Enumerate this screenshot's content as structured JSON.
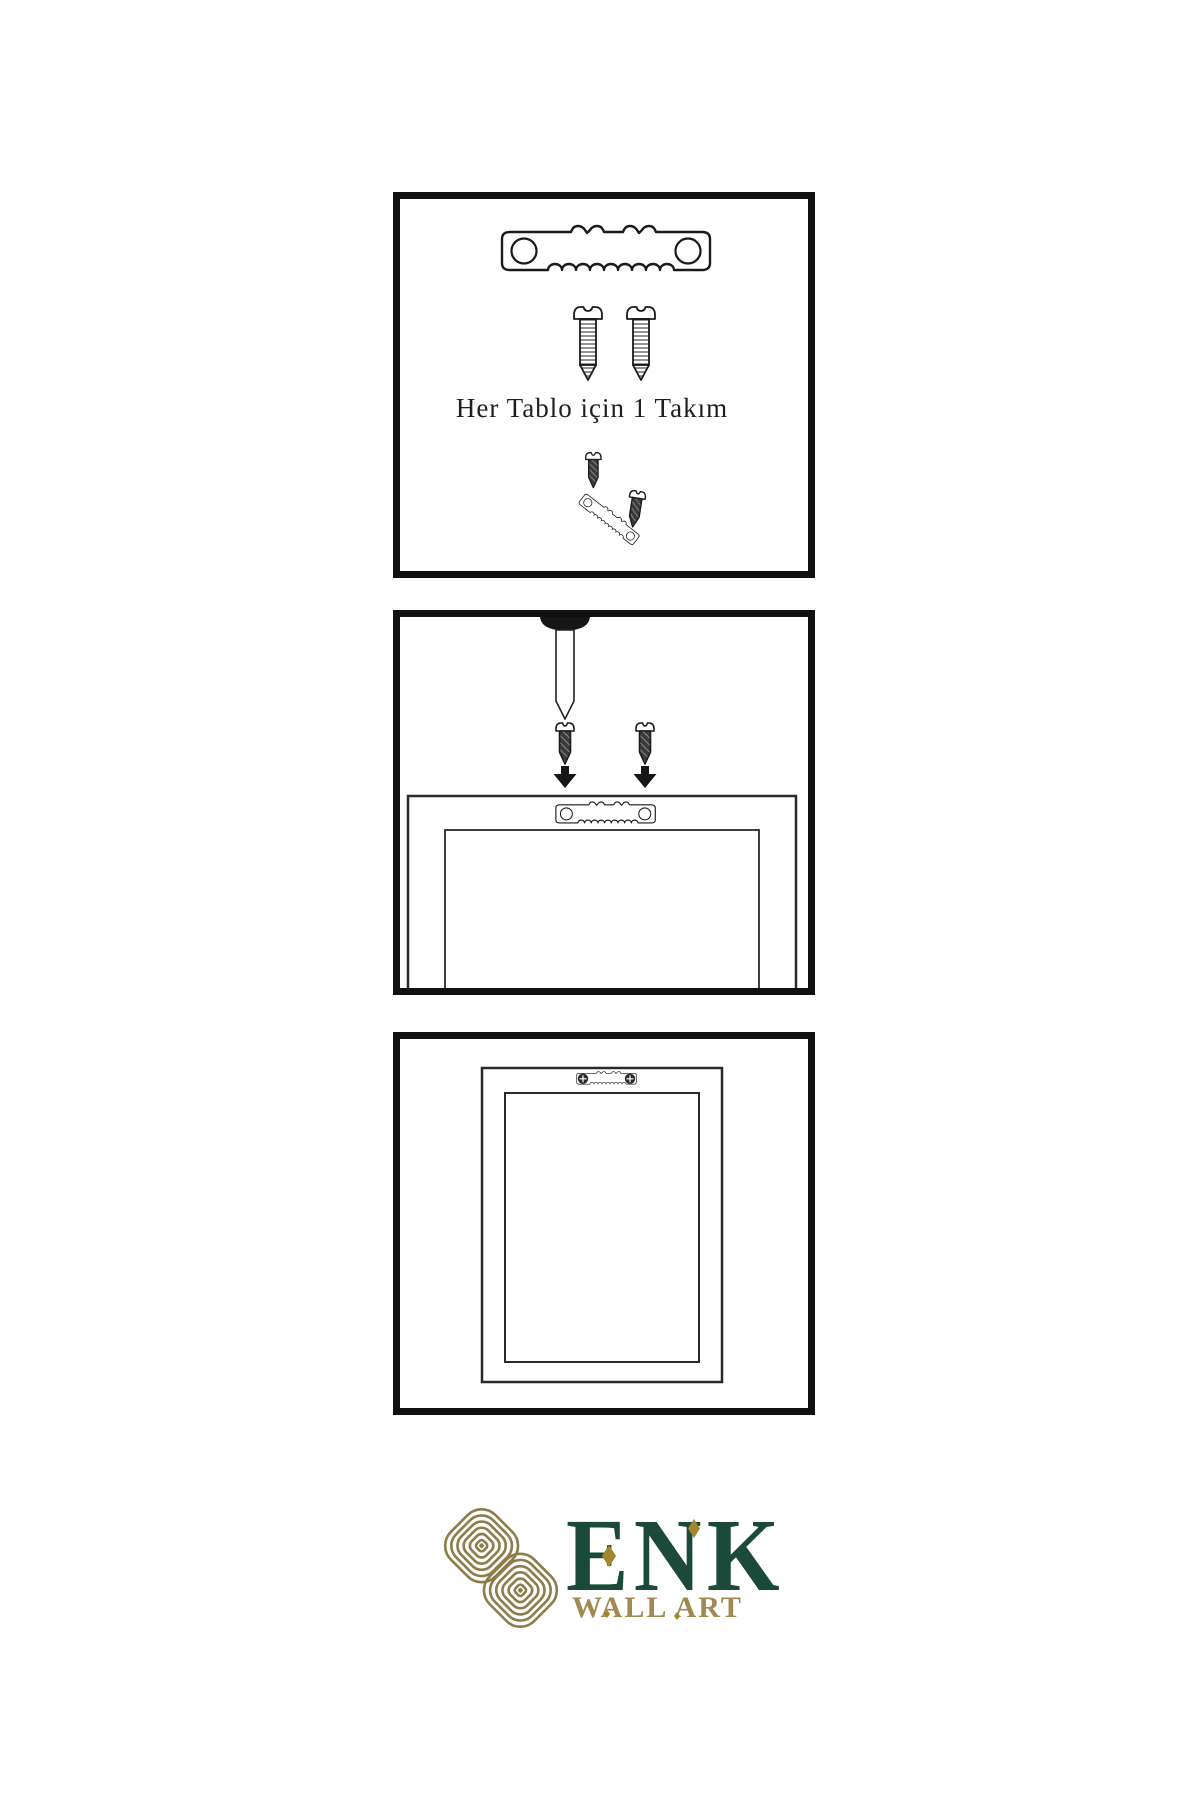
{
  "background": "#ffffff",
  "panel1": {
    "caption": "Her Tablo için 1 Takım"
  },
  "brand": {
    "name": "ENK",
    "subtitle": "WALL ART",
    "name_color": "#1b4a3b",
    "subtitle_color": "#a08a50",
    "knot_color": "#8d7c4a",
    "diamond_color": "#a3852e"
  },
  "colors": {
    "panel_border": "#111111",
    "line_art": "#1a1a1a",
    "dark_metal": "#3b3b3b"
  },
  "icons": {
    "sawtooth_hanger": "sawtooth-hanger-icon",
    "light_screw": "screw-icon",
    "dark_screw": "dark-screw-icon",
    "nail": "nail-icon",
    "arrow_down": "arrow-down-icon",
    "frame_back": "frame-back-icon",
    "picture_frame": "picture-frame-icon",
    "knot": "knot-logo-icon"
  }
}
